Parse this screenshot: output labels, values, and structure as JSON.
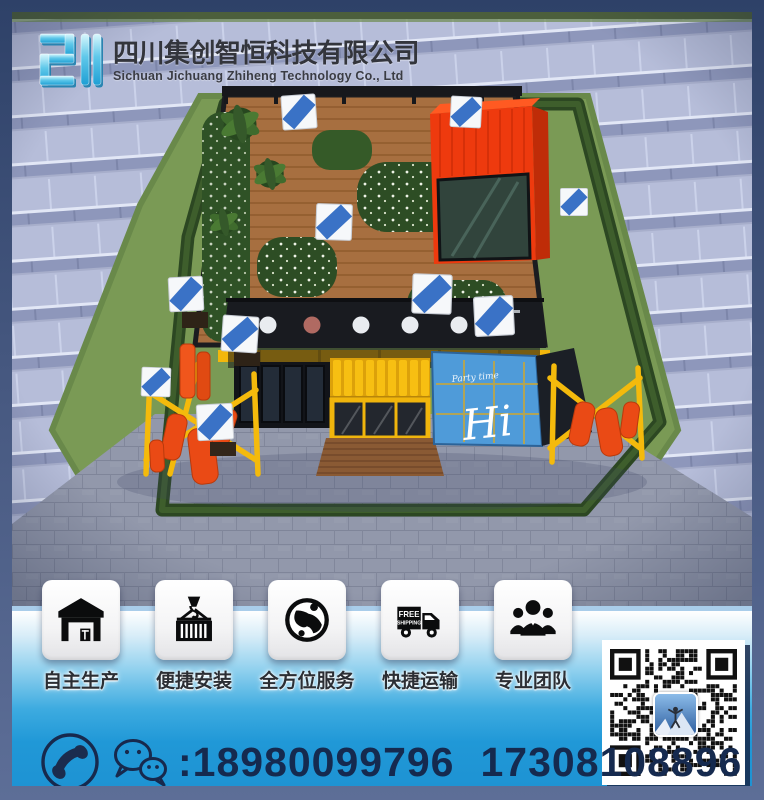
{
  "header": {
    "company_cn": "四川集创智恒科技有限公司",
    "company_en": "Sichuan Jichuang Zhiheng Technology Co., Ltd",
    "logo_icon": "jichuang-logo-mark",
    "logo_colors": [
      "#d9f7fd",
      "#23a4d8"
    ]
  },
  "scene": {
    "description_icon": "container-building-render",
    "graffiti_main": "Hi",
    "graffiti_small": "Party time",
    "colors": {
      "red_container": "#ee3a0e",
      "yellow_container": "#f5b90d",
      "blue_container": "#4f9bd9",
      "deck_wood": "#a76f40",
      "grass": "#7a9a55",
      "paving_light": "#b6bdd9",
      "paving_dark": "#8e97bb",
      "cobble": "#9298ab",
      "frame_border": "#56688f",
      "bottom_band": "#1f9bd9"
    }
  },
  "features": [
    {
      "label": "自主生产",
      "icon": "warehouse-icon"
    },
    {
      "label": "便捷安装",
      "icon": "container-hook-icon"
    },
    {
      "label": "全方位服务",
      "icon": "globe-icon"
    },
    {
      "label": "快捷运输",
      "icon": "truck-icon",
      "badge_line1": "FREE",
      "badge_line2": "SHIPPING"
    },
    {
      "label": "专业团队",
      "icon": "team-icon"
    }
  ],
  "contact": {
    "icons": [
      "phone-icon",
      "wechat-icon"
    ],
    "separator": ":",
    "phone_1": "18980099796",
    "phone_2": "17308108896"
  },
  "qr": {
    "name": "wechat-qr-code"
  }
}
